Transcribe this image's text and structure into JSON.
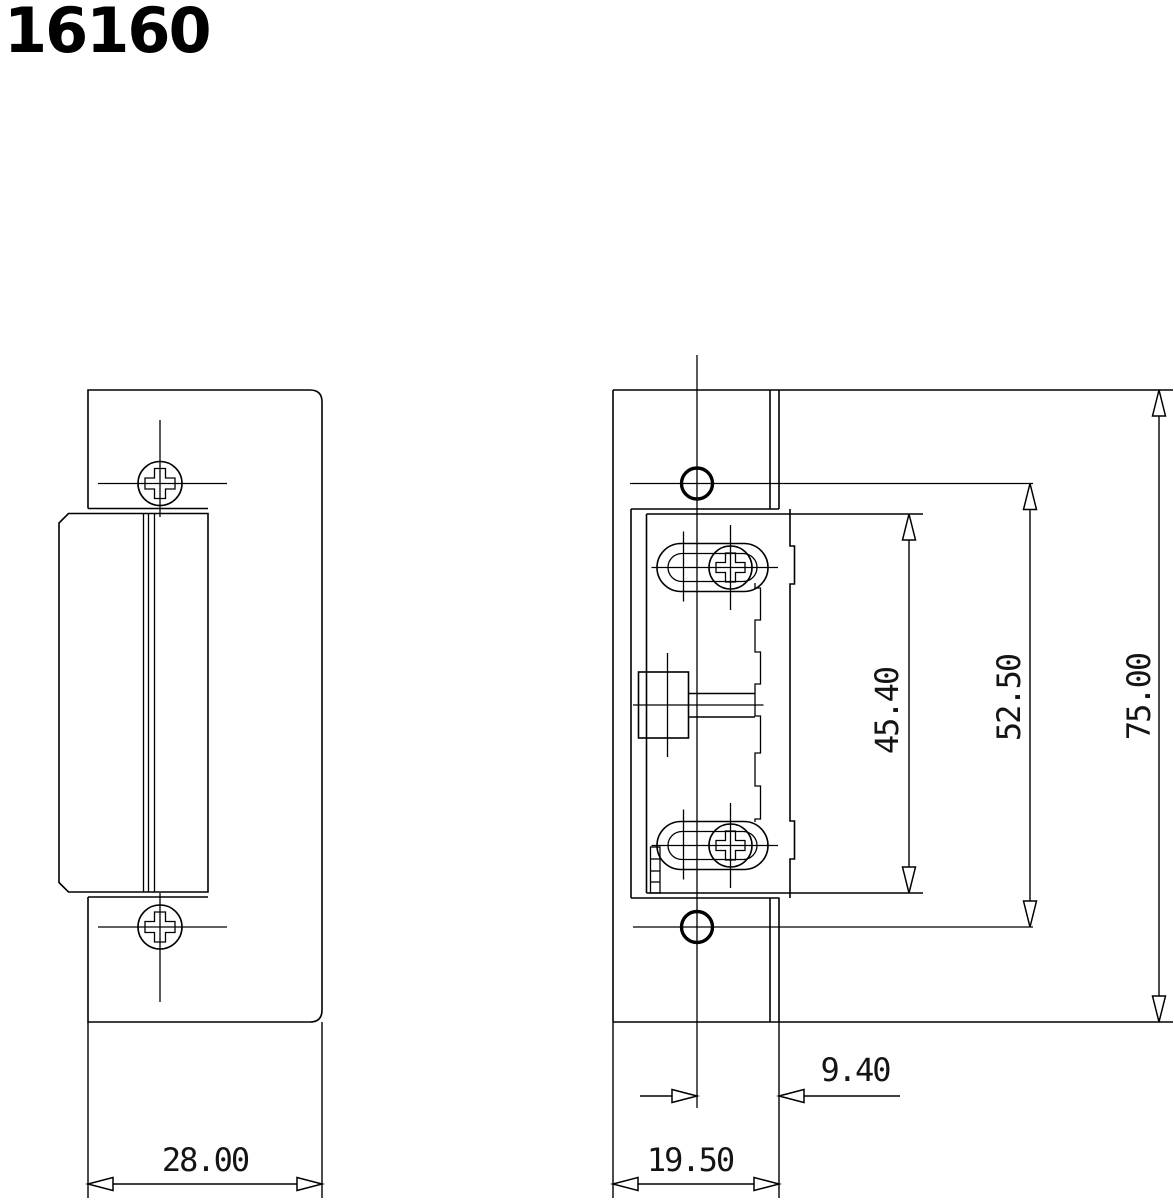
{
  "title": "16160",
  "drawing": {
    "kind": "technical-drawing",
    "subject": "electric-door-strike",
    "line_color": "#000000",
    "background_color": "#ffffff"
  },
  "dimensions": {
    "faceplate_width": {
      "label": "28.00",
      "value": 28.0
    },
    "faceplate_height": {
      "label": "75.00",
      "value": 75.0
    },
    "hole_spacing": {
      "label": "52.50",
      "value": 52.5
    },
    "body_height": {
      "label": "45.40",
      "value": 45.4
    },
    "body_depth": {
      "label": "19.50",
      "value": 19.5
    },
    "lip_depth": {
      "label": "9.40",
      "value": 9.4
    }
  }
}
